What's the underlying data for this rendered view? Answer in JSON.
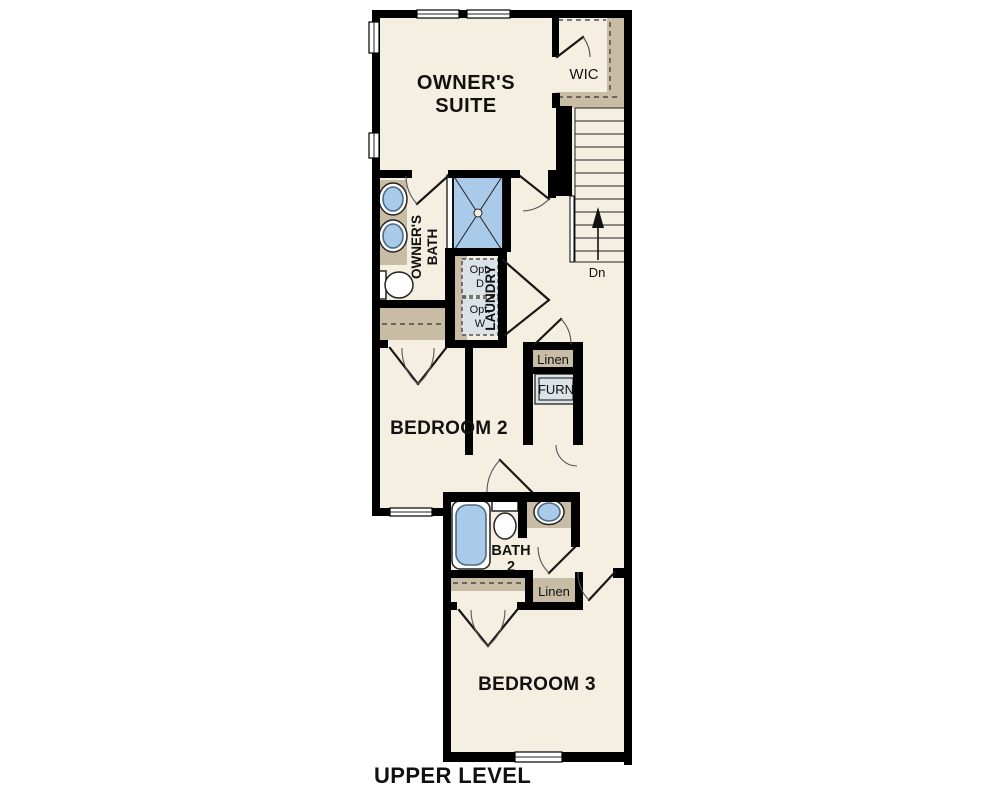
{
  "title": "UPPER LEVEL",
  "colors": {
    "floor": "#f5efe2",
    "shelf": "#c8bca4",
    "water": "#a9cbe9",
    "water_edge": "#4a6a85",
    "unit": "#dce3e8",
    "wall": "#000000",
    "ink": "#111111"
  },
  "rooms": {
    "owners_suite": {
      "line1": "OWNER'S",
      "line2": "SUITE"
    },
    "wic": {
      "label": "WIC"
    },
    "owners_bath": {
      "line1": "OWNER'S",
      "line2": "BATH"
    },
    "laundry": {
      "label": "LAUNDRY"
    },
    "bedroom2": {
      "label": "BEDROOM 2"
    },
    "bath2": {
      "line1": "BATH",
      "line2": "2"
    },
    "bedroom3": {
      "label": "BEDROOM 3"
    },
    "linen_upper": {
      "label": "Linen"
    },
    "linen_lower": {
      "label": "Linen"
    },
    "furnace": {
      "label": "FURN"
    }
  },
  "appliances": {
    "optional_dryer": {
      "line1": "Opt.",
      "line2": "D"
    },
    "optional_washer": {
      "line1": "Opt.",
      "line2": "W"
    }
  },
  "stairs": {
    "direction_label": "Dn"
  }
}
